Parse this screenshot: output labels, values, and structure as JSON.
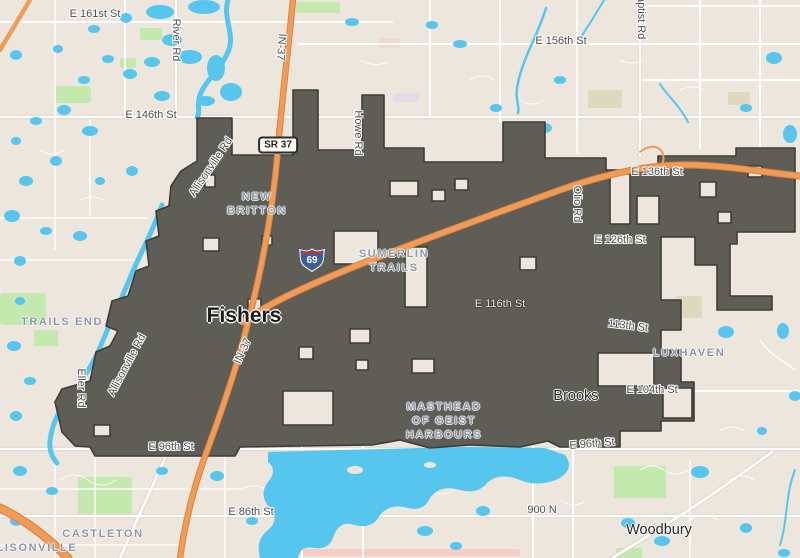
{
  "map": {
    "city": "Fishers",
    "towns": {
      "brooks": "Brooks",
      "woodbury": "Woodbury"
    },
    "streets": {
      "e161": "E 161st St",
      "e156": "E 156th St",
      "e146": "E 146th St",
      "e136": "E 136th St",
      "e126": "E 126th St",
      "e116": "E 116th St",
      "s113": "113th St",
      "e104": "E 104th St",
      "e96": "E 96th St",
      "e86": "E 86th St",
      "n900": "900 N"
    },
    "roads": {
      "river": "River Rd",
      "baptist": "Baptist Rd",
      "howe": "Howe Rd",
      "olio": "Olio Rd",
      "allisonville": "Allisonville Rd",
      "eller": "Eller Rd",
      "in37": "IN-37"
    },
    "shields": {
      "sr37": "SR 37",
      "i69": "69"
    },
    "neighborhoods": {
      "new_britton_l1": "NEW",
      "new_britton_l2": "BRITTON",
      "sumerlin_l1": "SUMERLIN",
      "sumerlin_l2": "TRAILS",
      "trails_end": "TRAILS END",
      "masthead_l1": "MASTHEAD",
      "masthead_l2": "OF GEIST",
      "masthead_l3": "HARBOURS",
      "luxhaven": "LUXHAVEN",
      "castleton": "CASTLETON",
      "allisonville": "ALLISONVILLE"
    },
    "colors": {
      "land": "#EDE6DD",
      "bfill": "#5E5D56",
      "bline": "#3D3C37",
      "water": "#56C6EE",
      "waterin": "#3E6C8B",
      "park": "#C4E9AE",
      "parkin": "#5F7656",
      "hwy": "#F09B57",
      "hwycase": "#DE8440",
      "road": "#FFFFFF",
      "roadcase": "#DBD4C9",
      "label": "#4E4D4A",
      "hood": "#8B96A6"
    }
  }
}
